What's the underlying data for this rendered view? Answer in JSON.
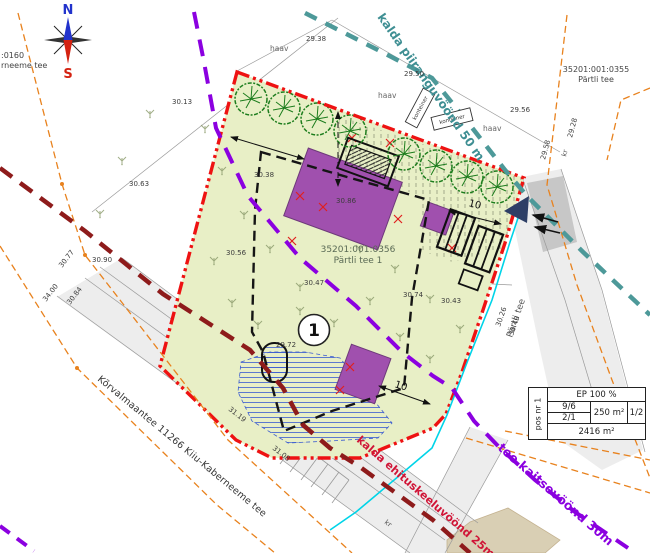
{
  "compass": {
    "north": "N",
    "south": "S"
  },
  "parcels": {
    "edge_parcel": {
      "line1": ":0160",
      "line2": "rneeme tee"
    },
    "road_parcel": {
      "code": "35201:001:0355",
      "name": "Pärtli tee"
    },
    "main_parcel": {
      "code": "35201:001:0356",
      "name": "Pärtli tee 1"
    }
  },
  "zones": {
    "shore_limit": "kalda piiranguvöönd 50 m",
    "road_protection": "tee kaitsevöönd 30m",
    "building_exclusion": "kalda ehituskeeluvöönd 25m"
  },
  "roads": {
    "main_road": "Kõrvalmaantee 11266 Kiiu-Kaberneeme tee",
    "side_road": "Pärtli tee"
  },
  "pos_circle": "1",
  "dimensions": {
    "parking": "10",
    "south": "10"
  },
  "tree_labels": [
    "haav",
    "haav",
    "haav"
  ],
  "feature_labels": {
    "container1": "konteiner",
    "container2": "konteiner",
    "kr1": "kr",
    "kr2": "kr"
  },
  "elevations": [
    "30.13",
    "29.38",
    "29.50",
    "29.56",
    "30.63",
    "30.38",
    "30.90",
    "30.56",
    "30.86",
    "30.47",
    "30.74",
    "30.43",
    "29.72",
    "30.77",
    "30.84",
    "34.00",
    "31.08",
    "31.19",
    "30.26",
    "30.49",
    "29.28",
    "29.58"
  ],
  "table": {
    "pos_label": "pos nr 1",
    "ep": "EP 100 %",
    "left_top": "9/6",
    "left_bottom": "2/1",
    "area": "250 m²",
    "ratio": "1/2",
    "total": "2416 m²"
  },
  "colors": {
    "boundary_red": "#ee1212",
    "zone_purple": "#8b00e0",
    "zone_maroon": "#8e1b1b",
    "zone_teal": "#4d9999",
    "building_purple": "#a050ae",
    "plot_fill": "#e8efc6",
    "utility_cyan": "#00d4e8",
    "utility_orange": "#e8821e"
  }
}
